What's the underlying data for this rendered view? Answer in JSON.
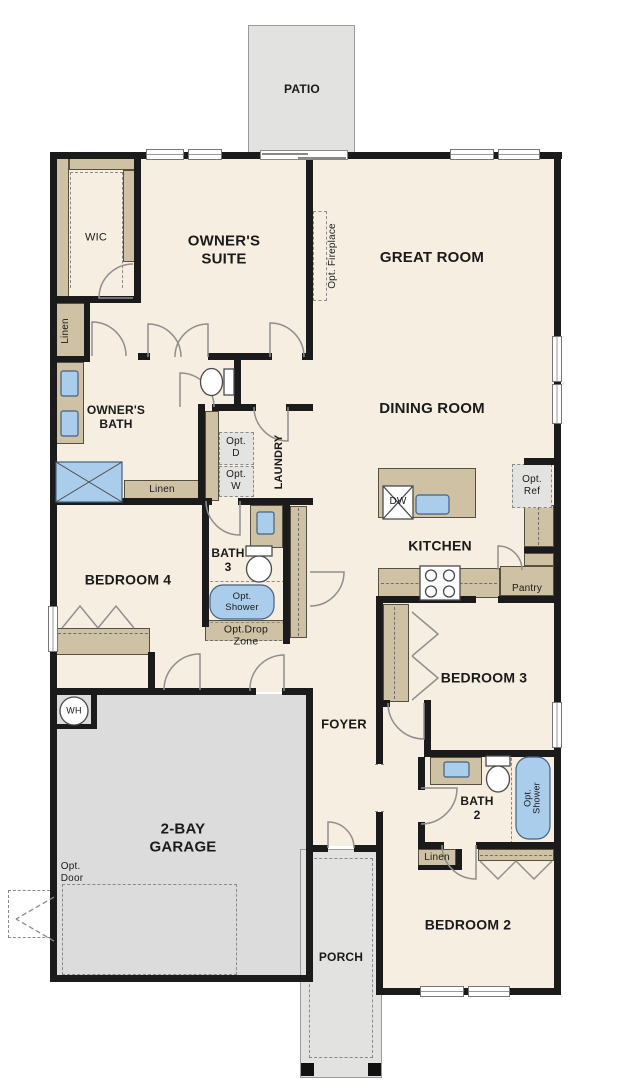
{
  "plan_title": "single-story floor plan",
  "colors": {
    "floor": "#f6eee0",
    "wall": "#1b1b1b",
    "cabinet_tan": "#cfc1a4",
    "concrete_grey": "#e2e2e1",
    "garage_grey": "#dcdcdc",
    "fixture_blue": "#a9cdeb",
    "option_grey": "#e3e3e2"
  },
  "rooms": {
    "patio": "PATIO",
    "owners_suite": "OWNER'S\nSUITE",
    "great_room": "GREAT ROOM",
    "wic": "WIC",
    "linen_hall": "Linen",
    "owners_bath": "OWNER'S\nBATH",
    "opt_fireplace": "Opt. Fireplace",
    "dining_room": "DINING ROOM",
    "laundry": "LAUNDRY",
    "opt_d": "Opt.\nD",
    "opt_w": "Opt.\nW",
    "linen_bath": "Linen",
    "bath3": "BATH\n3",
    "opt_shower_bath3": "Opt.\nShower",
    "opt_drop_zone": "Opt.Drop\nZone",
    "bedroom4": "BEDROOM 4",
    "kitchen": "KITCHEN",
    "dw": "DW",
    "opt_ref": "Opt.\nRef",
    "pantry": "Pantry",
    "bedroom3": "BEDROOM 3",
    "foyer": "FOYER",
    "wh": "WH",
    "garage": "2-BAY\nGARAGE",
    "opt_door": "Opt.\nDoor",
    "bath2": "BATH\n2",
    "opt_shower_bath2": "Opt.\nShower",
    "linen_bath2": "Linen",
    "bedroom2": "BEDROOM 2",
    "porch": "PORCH"
  }
}
